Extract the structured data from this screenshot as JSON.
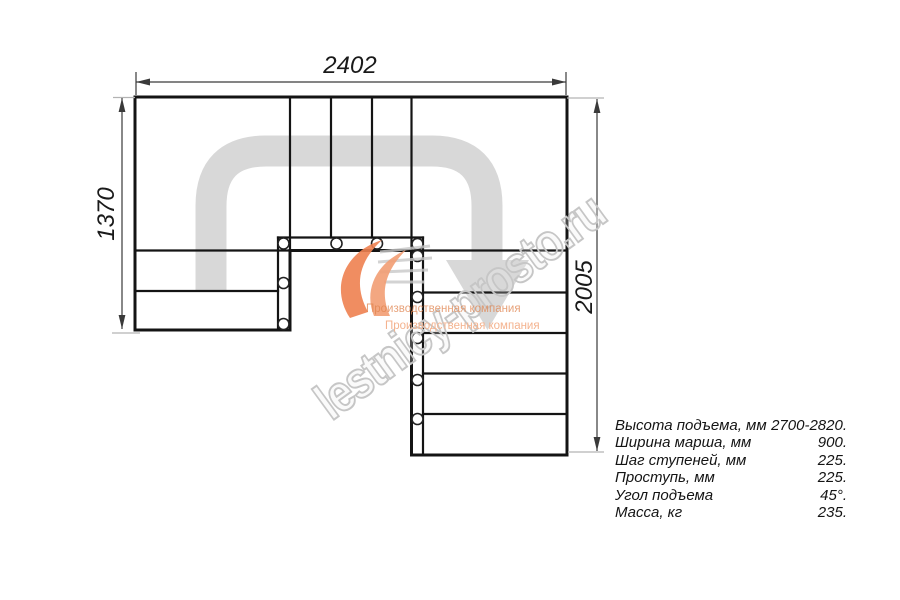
{
  "drawing": {
    "dimensions": {
      "width": "2402",
      "left_height": "1370",
      "right_height": "2005"
    }
  },
  "specs": {
    "rows": [
      {
        "label": "Высота подъема, мм",
        "value": "2700-2820."
      },
      {
        "label": "Ширина марша, мм",
        "value": "900."
      },
      {
        "label": "Шаг ступеней, мм",
        "value": "225."
      },
      {
        "label": "Проступь, мм",
        "value": "225."
      },
      {
        "label": "Угол подъема",
        "value": "45°."
      },
      {
        "label": "Масса, кг",
        "value": "235."
      }
    ]
  },
  "watermark": {
    "site": "lestnicy-prosto.ru",
    "tagline_top": "Производственная компания",
    "tagline_bottom": "Производственная компания"
  },
  "colors": {
    "line": "#141414",
    "dimension_line": "#3a3a3a",
    "extension_line": "#b3b3b3",
    "direction_band": "#d8d8d8",
    "watermark_gray": "#c6c6c6",
    "logo_orange": "#ee8150"
  }
}
